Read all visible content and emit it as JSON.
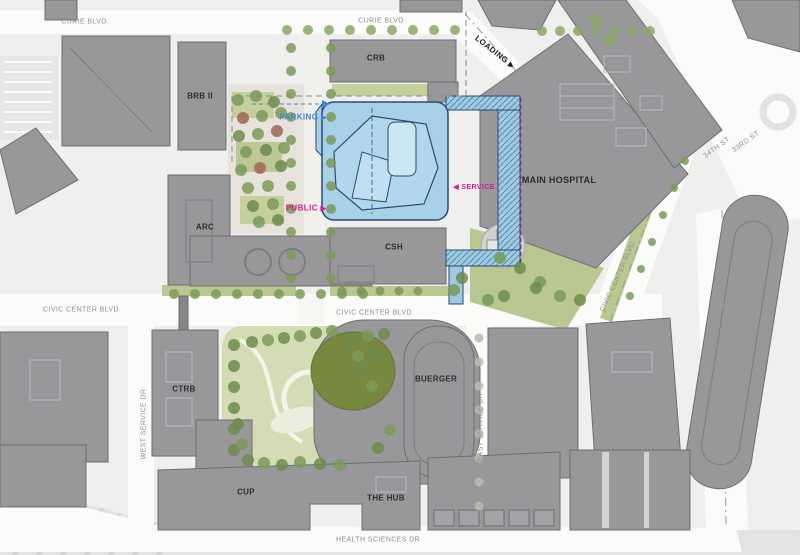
{
  "title": "Campus site plan",
  "roads": {
    "curie_left": "CURIE BLVD",
    "curie_mid": "CURIE BLVD",
    "civic_left": "CIVIC CENTER BLVD",
    "civic_mid": "CIVIC CENTER BLVD",
    "civic_right": "CIVIC CENTER BLVD",
    "health_sciences": "HEALTH SCIENCES DR",
    "west_service": "WEST SERVICE DR",
    "east_service": "EAST SERVICE DR",
    "convention": "CONVENTION AVE",
    "st34": "34TH ST",
    "st33": "33RD ST"
  },
  "buildings": {
    "crb": "CRB",
    "brb": "BRB II",
    "arc": "ARC",
    "csh": "CSH",
    "main_hospital": "MAIN HOSPITAL",
    "ctrb": "CTRB",
    "buerger": "BUERGER",
    "cup": "CUP",
    "the_hub": "THE HUB"
  },
  "annotations": {
    "loading": "LOADING",
    "parking": "PARKING",
    "public": "PUBLIC",
    "service": "SERVICE",
    "loading_arrow": "▶",
    "parking_arrow": "▶",
    "public_arrow": "▶",
    "service_arrow": "◀"
  },
  "colors": {
    "building_gray": "#98989b",
    "building_stroke": "#6e6e71",
    "new_building_fill": "#a8d1e8",
    "new_building_outline": "#2b4a6f",
    "accent_magenta": "#d6188c",
    "accent_blue_text": "#3f83d6",
    "green_landscape": "#b9c890",
    "road_white": "#fbfbf9"
  }
}
